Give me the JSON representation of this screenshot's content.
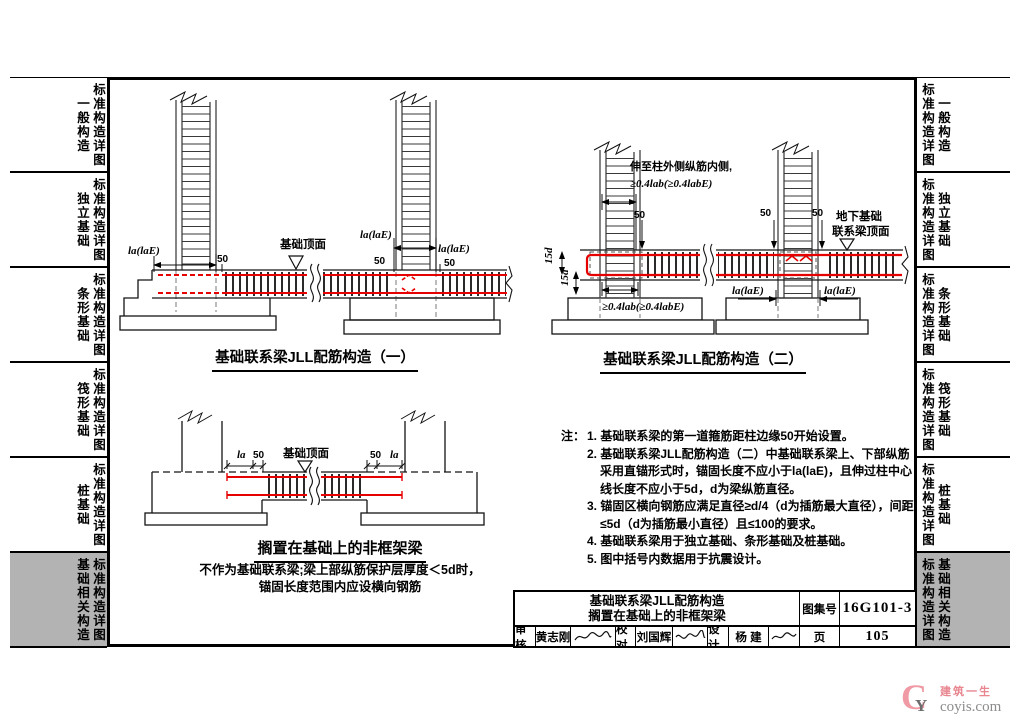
{
  "sidebar": {
    "tab_label": "标准构造详图",
    "items": [
      {
        "category": "一般构造",
        "active": false
      },
      {
        "category": "独立基础",
        "active": false
      },
      {
        "category": "条形基础",
        "active": false
      },
      {
        "category": "筏形基础",
        "active": false
      },
      {
        "category": "桩基础",
        "active": false
      },
      {
        "category": "基础相关构造",
        "active": true
      }
    ]
  },
  "diagrams": {
    "d1": {
      "title": "基础联系梁JLL配筋构造（一）",
      "labels": {
        "la_lae": "la(laE)",
        "n50": "50",
        "top_surface": "基础顶面"
      }
    },
    "d2": {
      "title": "基础联系梁JLL配筋构造（二）",
      "labels": {
        "extend_line1": "伸至柱外侧纵筋内侧,",
        "extend_line2": "≥0.4lab(≥0.4labE)",
        "n50": "50",
        "underground_line1": "地下基础",
        "underground_line2": "联系梁顶面",
        "hook_15d": "15d",
        "anchor_bottom": "≥0.4lab(≥0.4labE)",
        "la_lae": "la(laE)"
      }
    },
    "d3": {
      "title": "搁置在基础上的非框架梁",
      "caption_line1": "不作为基础联系梁;梁上部纵筋保护层厚度＜5d时，",
      "caption_line2": "锚固长度范围内应设横向钢筋",
      "labels": {
        "la": "la",
        "n50": "50",
        "top_surface": "基础顶面"
      }
    }
  },
  "notes": {
    "prefix": "注：",
    "items": [
      "1. 基础联系梁的第一道箍筋距柱边缘50开始设置。",
      "2. 基础联系梁JLL配筋构造（二）中基础联系梁上、下部纵筋采用直锚形式时，锚固长度不应小于la(laE)，且伸过柱中心线长度不应小于5d，d为梁纵筋直径。",
      "3. 锚固区横向钢筋应满足直径≥d/4（d为插筋最大直径），间距≤5d（d为插筋最小直径）且≤100的要求。",
      "4. 基础联系梁用于独立基础、条形基础及桩基础。",
      "5. 图中括号内数据用于抗震设计。"
    ]
  },
  "title_block": {
    "title_line1": "基础联系梁JLL配筋构造",
    "title_line2": "搁置在基础上的非框架梁",
    "atlas_label": "图集号",
    "atlas_no": "16G101-3",
    "page_label": "页",
    "page_no": "105",
    "review_label": "审核",
    "reviewer": "黄志刚",
    "check_label": "校对",
    "checker": "刘国辉",
    "design_label": "设计",
    "designer": "杨 建"
  },
  "watermark": {
    "brand": "建筑一生",
    "site": "coyis.com"
  },
  "colors": {
    "rebar_red": "#e60000",
    "active_tab_bg": "#b3b3b3",
    "brand_pink": "#f09aa5"
  }
}
